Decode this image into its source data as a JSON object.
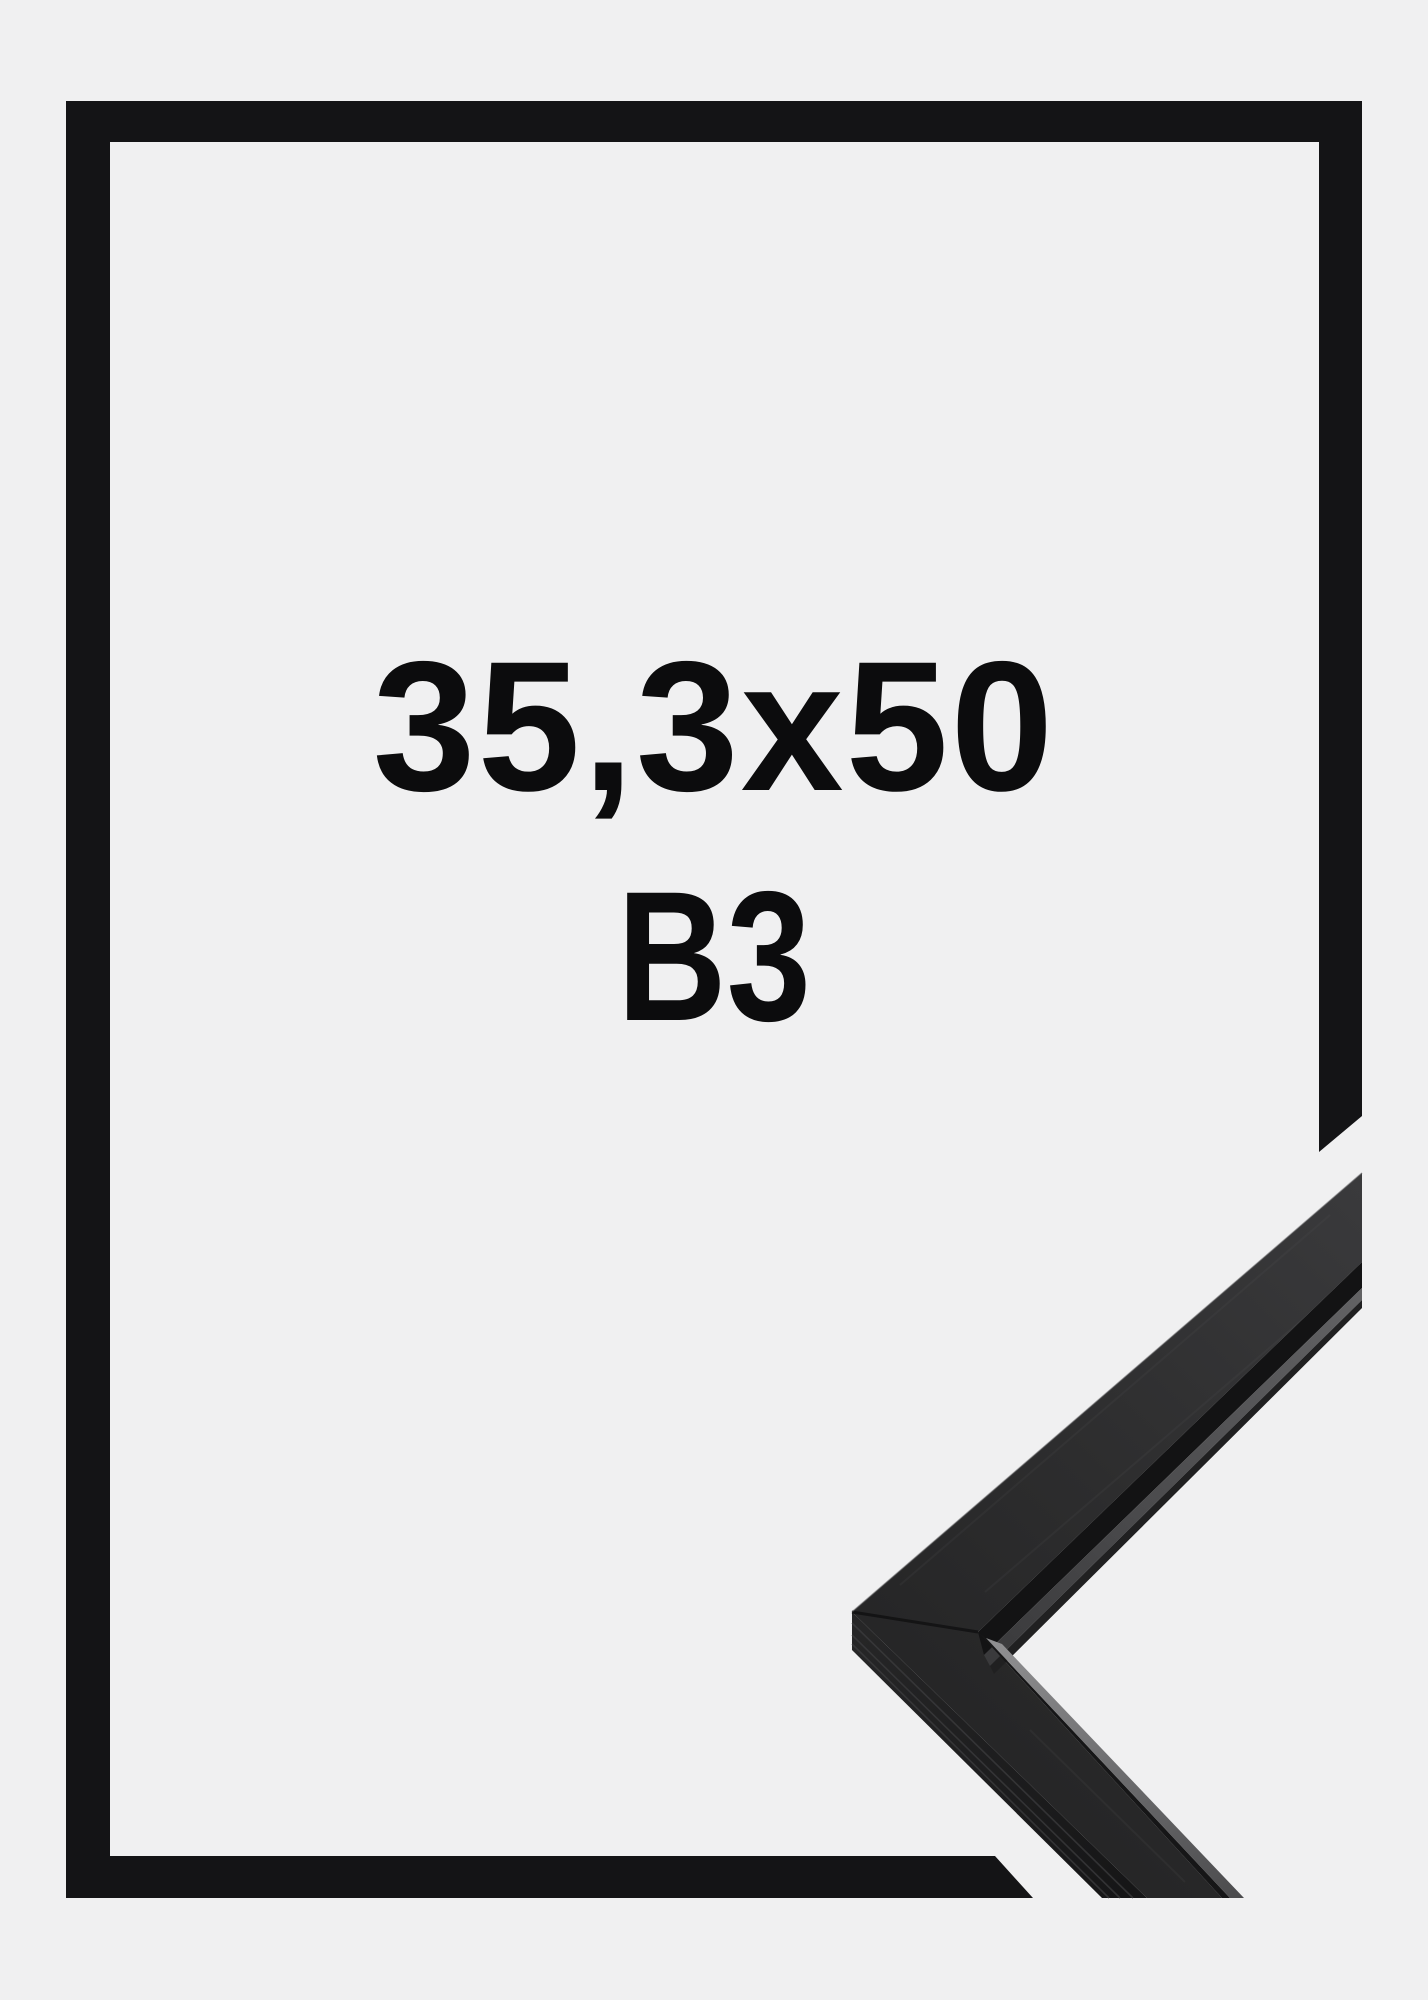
{
  "frame_mockup": {
    "size_label": "35,3x50",
    "format_label": "B3"
  },
  "colors": {
    "background": "#f0f0f1",
    "frame_graphic": "#141416",
    "label_text": "#0c0c0d",
    "moulding_face_light": "#39393b",
    "moulding_face_dark": "#242425",
    "moulding_groove": "#131314",
    "moulding_lip_highlight": "#8f8f91",
    "moulding_side_face": "#1d1d1e"
  }
}
